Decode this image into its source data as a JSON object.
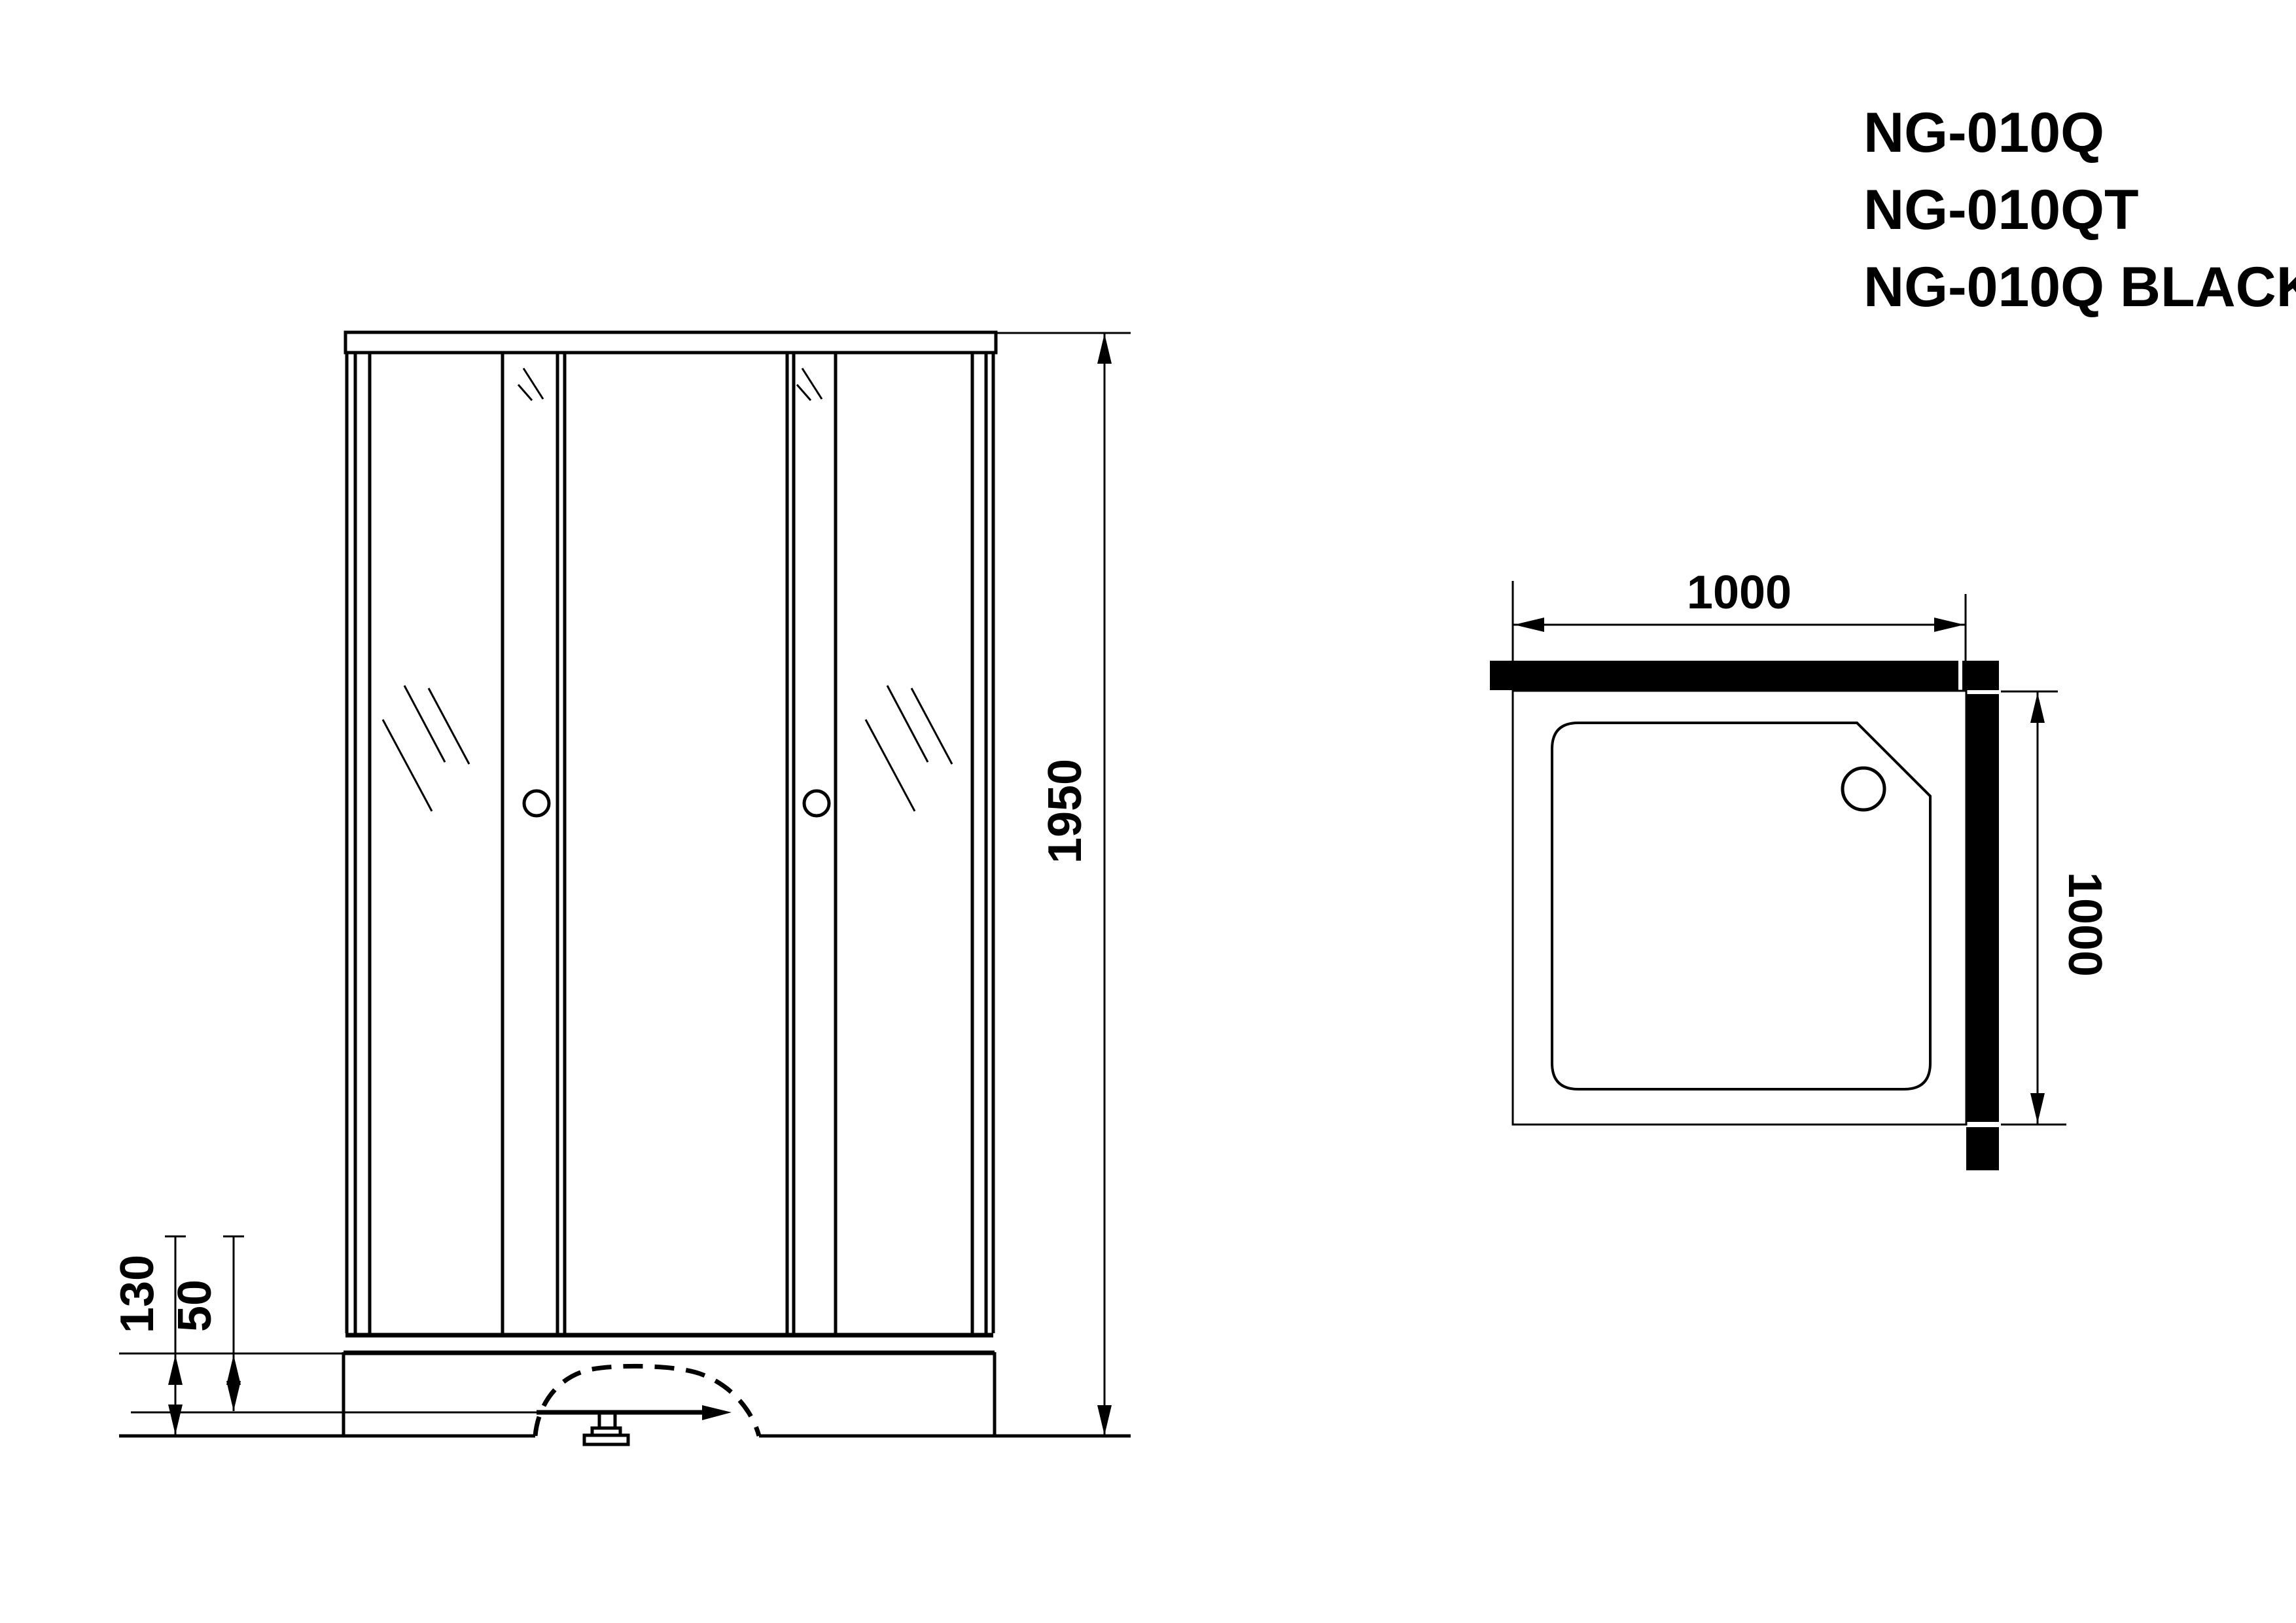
{
  "drawing": {
    "background_color": "#ffffff",
    "line_color": "#000000"
  },
  "models": [
    {
      "label": "NG-010Q"
    },
    {
      "label": "NG-010QT"
    },
    {
      "label": "NG-010Q BLACK"
    }
  ],
  "front_view": {
    "height": "1950",
    "base_height": "130",
    "base_clearance": "50"
  },
  "top_view": {
    "width": "1000",
    "depth": "1000"
  }
}
